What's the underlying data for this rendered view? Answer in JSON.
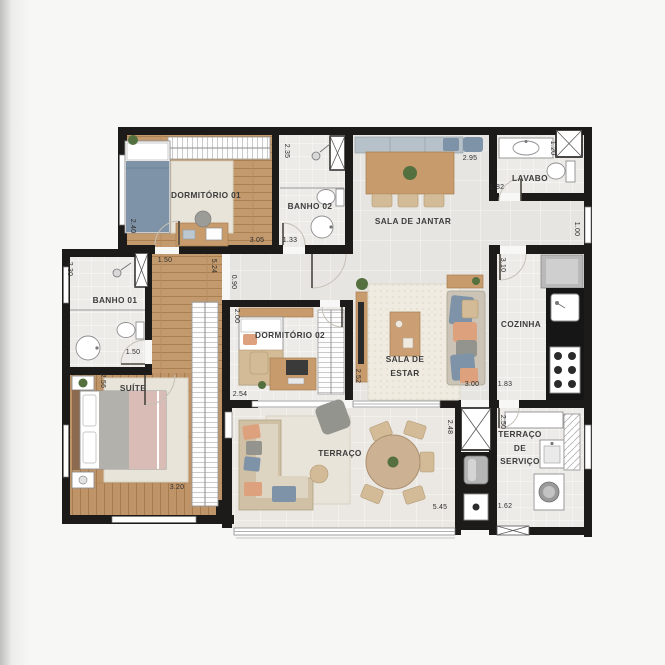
{
  "rooms": {
    "dormitorio_01": {
      "label": "DORMITÓRIO 01"
    },
    "banho_02": {
      "label": "BANHO 02"
    },
    "sala_de_jantar": {
      "label": "SALA DE JANTAR"
    },
    "lavabo": {
      "label": "LAVABO"
    },
    "cozinha": {
      "label": "COZINHA"
    },
    "sala_de_estar": {
      "line1": "SALA DE",
      "line2": "ESTAR"
    },
    "dormitorio_02": {
      "label": "DORMITÓRIO 02"
    },
    "banho_01": {
      "label": "BANHO 01"
    },
    "suite": {
      "label": "SUÍTE"
    },
    "terraco": {
      "label": "TERRAÇO"
    },
    "terraco_de_servico": {
      "line1": "TERRAÇO",
      "line2": "DE",
      "line3": "SERVIÇO"
    }
  },
  "dimensions": {
    "dorm01_depth": "2.40",
    "dorm01_width": "3.05",
    "banho02_depth": "2.35",
    "banho02_width": "1.33",
    "sala_jantar_width": "2.95",
    "lavabo_depth": "1.20",
    "lavabo_width": "1.82",
    "passage_right_depth": "1.00",
    "cozinha_depth": "3.10",
    "cozinha_width": "1.83",
    "banho01_depth": "2.30",
    "banho01_width": "1.50",
    "hall_width": "1.50",
    "corridor_depth": "5.24",
    "corridor_width": "0.90",
    "dorm02_depth": "2.00",
    "dorm02_width": "2.54",
    "dorm02_right_depth": "2.52",
    "suite_depth": "2.56",
    "suite_width": "3.20",
    "sala_estar_width": "3.00",
    "terraco_depth": "2.48",
    "terraco_width": "5.45",
    "servico_depth": "2.50",
    "servico_width": "1.62"
  },
  "colors": {
    "wall": "#1c1b19",
    "wood_floor": "#c39a6d",
    "wood_furniture": "#c89b6d",
    "tile_light": "#ecebe8",
    "tile_living": "#e7e5e1",
    "rug": "#e9e4d9",
    "accent_blue": "#7e93a7",
    "accent_orange": "#dda17e",
    "sofa_gray": "#94948f",
    "plant_green": "#55703f",
    "label_text": "#3c3c3c",
    "dim_text": "#2e2e2e",
    "counter_black": "#161616",
    "bench_blue_gray": "#b7c1c9",
    "bed_gray": "#b3b1ab",
    "bed_pink": "#d9bcb6",
    "chair_tan": "#d3bb97"
  }
}
